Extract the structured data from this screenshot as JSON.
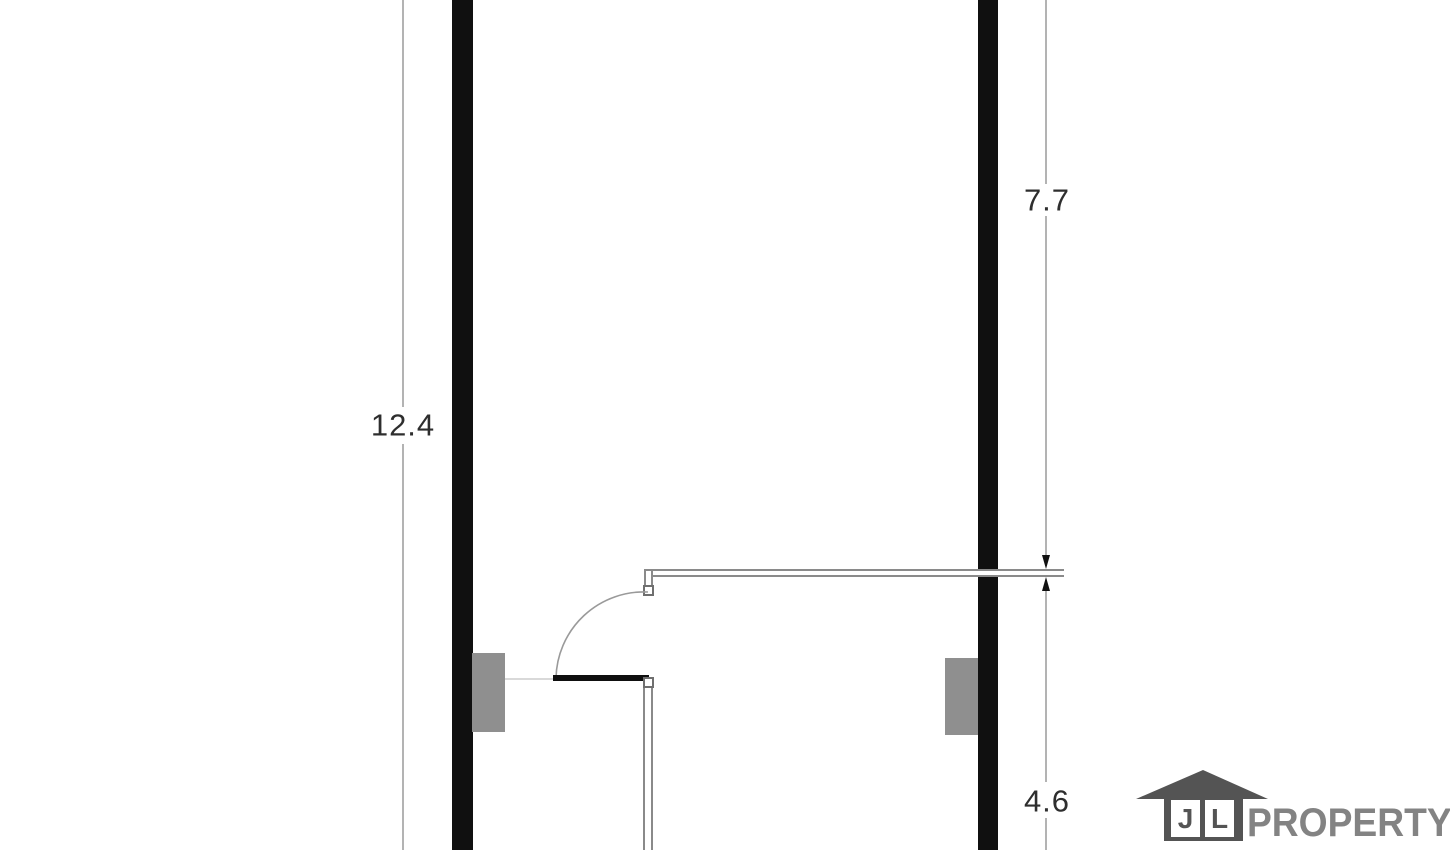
{
  "plan": {
    "type": "floor-plan",
    "dimensions": {
      "left_total": {
        "label": "12.4"
      },
      "right_upper": {
        "label": "7.7"
      },
      "right_lower": {
        "label": "4.6"
      }
    },
    "logo": {
      "letter_j": "J",
      "letter_l": "L",
      "brand": "PROPERTY"
    },
    "colors": {
      "wall": "#101010",
      "pilaster": "#8f8f8f",
      "dimension_line": "#b3b3b3",
      "partition_line": "#8a8a8a",
      "door_arc": "#9a9a9a",
      "door_leaf": "#0f0f0f",
      "label_text": "#2e2e2e",
      "logo_house": "#545454",
      "logo_text": "#838383"
    }
  }
}
